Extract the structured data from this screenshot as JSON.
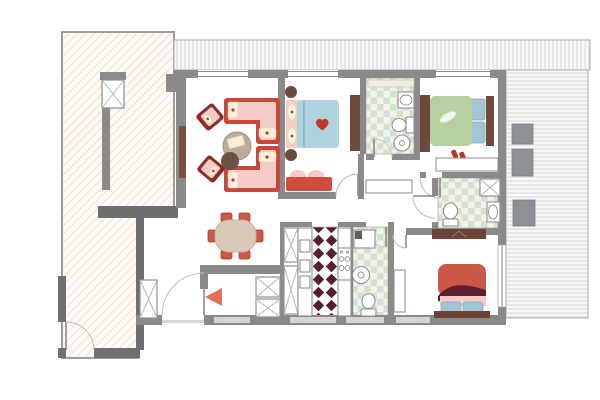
{
  "title": "apartment-floor-plan",
  "palette": {
    "wall": "#8a8a8a",
    "wall_dark": "#6f6f6f",
    "wall_light": "#d7d4cf",
    "terrace_bg": "#fdfaf6",
    "terrace_hatch": "#eed3c9",
    "deck_bg": "#f7f7f7",
    "deck_stripe": "#d6d6d6",
    "tile_a": "#cfe0d9",
    "tile_b": "#f6f2e1",
    "diamond": "#571d30",
    "wood": "#6e4a3c",
    "tan": "#bcab97",
    "sofa_red": "#c8473b",
    "pink": "#f5cbc7",
    "cream": "#f8efda",
    "armchair": "#8e2d28",
    "bed_blue": "#aed3df",
    "bed_green": "#b6d0a0",
    "bed_red": "#cd5746",
    "maroon": "#5b1f2f",
    "pillow_blue": "#a2c5d6",
    "chair_red": "#cb5747",
    "arrow": "#e07357",
    "fixture": "#8f8f8f",
    "xmark": "#b5b5b5",
    "door_arc": "#c9c2ba",
    "gray_box": "#8d9094",
    "heart_red": "#c0392b"
  },
  "rooms": [
    {
      "id": "terrace-left",
      "floor": "diagonal-hatch",
      "features": [
        "service-shaft",
        "exterior-door"
      ]
    },
    {
      "id": "deck-top",
      "floor": "plank-stripes"
    },
    {
      "id": "deck-right",
      "floor": "plank-stripes",
      "features": [
        "planter-box",
        "planter-box",
        "planter-box"
      ]
    },
    {
      "id": "living-room",
      "furniture": [
        "wall-tv",
        "sectional-sofa-top",
        "sectional-sofa-bottom",
        "armchair",
        "armchair",
        "round-coffee-table",
        "round-side-table"
      ]
    },
    {
      "id": "dining-area",
      "furniture": [
        "oval-table",
        "chair",
        "chair",
        "chair",
        "chair",
        "chair",
        "chair"
      ]
    },
    {
      "id": "bedroom-blue",
      "furniture": [
        "double-bed-heart-pillow",
        "nightstand",
        "nightstand",
        "bench-loveseat",
        "wardrobe"
      ]
    },
    {
      "id": "bathroom-shared",
      "floor": "checker-tile",
      "fixtures": [
        "shelf",
        "sink",
        "toilet",
        "bidet"
      ]
    },
    {
      "id": "bedroom-green",
      "furniture": [
        "double-bed-feather",
        "wardrobe",
        "closet-rail",
        "slippers"
      ]
    },
    {
      "id": "bathroom-ensuite",
      "floor": "checker-tile",
      "fixtures": [
        "shower-stall",
        "toilet",
        "sink"
      ]
    },
    {
      "id": "kitchen",
      "floor": "harlequin-diamond",
      "fixtures": [
        "tall-cabinet",
        "tall-cabinet",
        "appliance-counter",
        "stove-4-burner"
      ]
    },
    {
      "id": "laundry-bathroom",
      "floor": "checker-tile",
      "fixtures": [
        "counter-unit",
        "washing-machine",
        "toilet"
      ]
    },
    {
      "id": "bedroom-master",
      "furniture": [
        "double-bed-red",
        "media-console",
        "radiator",
        "balcony-door"
      ]
    },
    {
      "id": "entry-hall",
      "furniture": [
        "closet",
        "closet",
        "closet"
      ],
      "features": [
        "entry-door",
        "entrance-arrow"
      ]
    }
  ]
}
